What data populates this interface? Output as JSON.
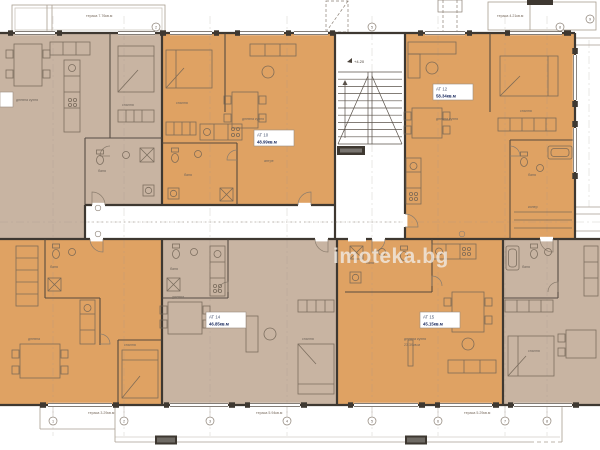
{
  "watermark": {
    "text": "imoteka.bg"
  },
  "colors": {
    "beige": "#c8b4a2",
    "orange": "#dfa263",
    "wall": "#3e3831",
    "thin_line": "#8b8075",
    "furniture": "#6f6254",
    "white": "#ffffff",
    "watermark": "#f1ede7"
  },
  "apartments": [
    {
      "id": "АТ 10",
      "area": "48.99кв.м"
    },
    {
      "id": "АТ 12",
      "area": "58.34кв.м"
    },
    {
      "id": "АТ 14",
      "area": "46.85кв.м"
    },
    {
      "id": "АТ 15",
      "area": "45.15кв.м"
    }
  ],
  "stairwell": {
    "level_mark": "+4.20"
  },
  "room_labels": [
    "дневна кухня",
    "спалня",
    "баня",
    "спалня",
    "дневна кухня",
    "антре",
    "баня",
    "дневна кухня",
    "спалня",
    "баня",
    "килер",
    "баня",
    "дневна",
    "спалня",
    "баня",
    "дневна кухня",
    "23.39кв.м",
    "спалня",
    "дневна",
    "баня",
    "спалня",
    "баня"
  ],
  "terrace_labels": [
    "тераса 7.76кв.м",
    "тераса 4.21кв.м",
    "тераса 3.29кв.м",
    "тераса 5.94кв.м",
    "тераса 5.29кв.м"
  ],
  "grid_marks_bottom": [
    "1",
    "2",
    "3",
    "4",
    "5",
    "6",
    "7",
    "8"
  ],
  "grid_marks_top": [
    "2",
    "5",
    "8"
  ],
  "grid_marks_right": [
    "9"
  ]
}
